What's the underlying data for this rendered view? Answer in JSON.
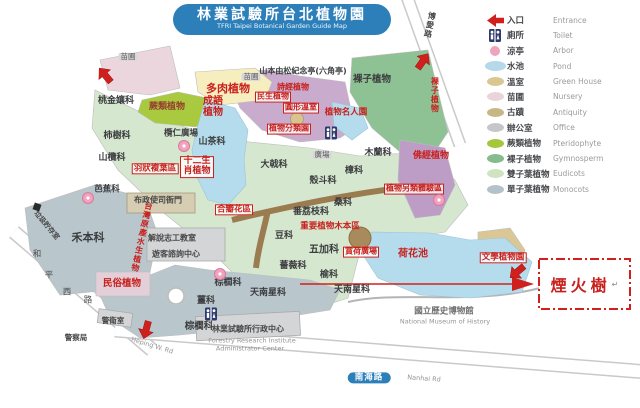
{
  "title": {
    "zh": "林業試驗所台北植物園",
    "en": "TFRI Taipei Botanical Garden Guide Map"
  },
  "legend": {
    "items": [
      {
        "id": "entrance",
        "zh": "入口",
        "en": "Entrance",
        "icon": "entrance-arrow-icon",
        "color": "#d0201e"
      },
      {
        "id": "toilet",
        "zh": "廁所",
        "en": "Toilet",
        "icon": "toilet-icon",
        "color": "#2d3a6e"
      },
      {
        "id": "arbor",
        "zh": "涼亭",
        "en": "Arbor",
        "icon": "circle",
        "color": "#f0a3bd"
      },
      {
        "id": "pond",
        "zh": "水池",
        "en": "Pond",
        "icon": "ellipse-wide",
        "color": "#b5d8ea"
      },
      {
        "id": "greenhouse",
        "zh": "溫室",
        "en": "Green House",
        "icon": "ellipse",
        "color": "#d9c78f"
      },
      {
        "id": "nursery",
        "zh": "苗圃",
        "en": "Nursery",
        "icon": "ellipse",
        "color": "#e9d4db"
      },
      {
        "id": "antiquity",
        "zh": "古蹟",
        "en": "Antiquity",
        "icon": "ellipse",
        "color": "#c8b687"
      },
      {
        "id": "office",
        "zh": "辦公室",
        "en": "Office",
        "icon": "ellipse",
        "color": "#c6c6ca"
      },
      {
        "id": "pteridophyte",
        "zh": "蕨類植物",
        "en": "Pteridophyte",
        "icon": "ellipse",
        "color": "#a5c73b"
      },
      {
        "id": "gymnosperm",
        "zh": "裸子植物",
        "en": "Gymnosperm",
        "icon": "ellipse",
        "color": "#85bb8d"
      },
      {
        "id": "eudicots",
        "zh": "雙子葉植物",
        "en": "Eudicots",
        "icon": "ellipse",
        "color": "#cfe3c2"
      },
      {
        "id": "monocots",
        "zh": "單子葉植物",
        "en": "Monocots",
        "icon": "ellipse",
        "color": "#b3c1c9"
      }
    ]
  },
  "callout": {
    "label": "煙火樹",
    "cursor_mark": "↵"
  },
  "map": {
    "labels": [
      {
        "id": "succulent-plants",
        "text": "多肉植物",
        "x": 228,
        "y": 89,
        "s": "red",
        "fs": 11
      },
      {
        "id": "idiom-plants",
        "text": "成語植物",
        "x": 213,
        "y": 107,
        "s": "red",
        "fs": 10,
        "w": 24
      },
      {
        "id": "fern-plants",
        "text": "蕨類植物",
        "x": 167,
        "y": 108,
        "s": "maroon",
        "fs": 9
      },
      {
        "id": "yamamoto-pavilion",
        "text": "山本由松紀念亭(六角亭)",
        "x": 303,
        "y": 72,
        "s": "dark",
        "fs": 8
      },
      {
        "id": "shijing-plants",
        "text": "詩經植物",
        "x": 293,
        "y": 88,
        "s": "red",
        "fs": 8
      },
      {
        "id": "minsheng-plants",
        "text": "民生植物",
        "x": 273,
        "y": 97,
        "s": "redbox",
        "fs": 8
      },
      {
        "id": "round-greenhouse",
        "text": "圓形溫室",
        "x": 301,
        "y": 108,
        "s": "redbox",
        "fs": 8
      },
      {
        "id": "plant-celebrity-garden",
        "text": "植物名人園",
        "x": 346,
        "y": 113,
        "s": "red",
        "fs": 8.5
      },
      {
        "id": "plant-taxonomy-garden",
        "text": "植物分類園",
        "x": 289,
        "y": 129,
        "s": "redbox",
        "fs": 8
      },
      {
        "id": "gymnosperm-area",
        "text": "裸子植物",
        "x": 372,
        "y": 80,
        "s": "dark",
        "fs": 9.5
      },
      {
        "id": "gymnosperm-area-vertical",
        "text": "裸子植物",
        "x": 434,
        "y": 95,
        "s": "redv",
        "fs": 8,
        "vert": true
      },
      {
        "id": "myrtaceae",
        "text": "桃金孃科",
        "x": 116,
        "y": 102,
        "s": "dark",
        "fs": 9
      },
      {
        "id": "nursery-label-1",
        "text": "苗圃",
        "x": 128,
        "y": 57,
        "s": "chip",
        "fs": 7.5
      },
      {
        "id": "nursery-label-2",
        "text": "苗圃",
        "x": 251,
        "y": 77,
        "s": "chip",
        "fs": 7.5
      },
      {
        "id": "ebenaceae",
        "text": "柿樹科",
        "x": 117,
        "y": 137,
        "s": "dark",
        "fs": 9
      },
      {
        "id": "sapotaceae",
        "text": "山欖科",
        "x": 112,
        "y": 159,
        "s": "dark",
        "fs": 9
      },
      {
        "id": "terminalia-plaza",
        "text": "欖仁廣場",
        "x": 181,
        "y": 134,
        "s": "dark",
        "fs": 8.5
      },
      {
        "id": "theaceae",
        "text": "山茶科",
        "x": 212,
        "y": 143,
        "s": "dark",
        "fs": 9
      },
      {
        "id": "pinnate-leaf-area",
        "text": "羽狀複葉區",
        "x": 155,
        "y": 169,
        "s": "redbox",
        "fs": 8.5
      },
      {
        "id": "zodiac-plants",
        "text": "十二生肖植物",
        "x": 197,
        "y": 167,
        "s": "redbox",
        "fs": 9,
        "w": 30
      },
      {
        "id": "euphorbiaceae",
        "text": "大戟科",
        "x": 274,
        "y": 166,
        "s": "dark",
        "fs": 9
      },
      {
        "id": "plaza-label",
        "text": "廣場",
        "x": 322,
        "y": 155,
        "s": "chip",
        "fs": 7.5
      },
      {
        "id": "magnoliaceae",
        "text": "木蘭科",
        "x": 378,
        "y": 154,
        "s": "dark",
        "fs": 9
      },
      {
        "id": "lauraceae",
        "text": "樟科",
        "x": 354,
        "y": 172,
        "s": "dark",
        "fs": 9
      },
      {
        "id": "fagaceae",
        "text": "殼斗科",
        "x": 323,
        "y": 182,
        "s": "dark",
        "fs": 9
      },
      {
        "id": "moraceae",
        "text": "桑科",
        "x": 343,
        "y": 204,
        "s": "dark",
        "fs": 9
      },
      {
        "id": "annonaceae",
        "text": "番荔枝科",
        "x": 311,
        "y": 213,
        "s": "dark",
        "fs": 9
      },
      {
        "id": "buddhist-sutra-plants",
        "text": "佛經植物",
        "x": 431,
        "y": 157,
        "s": "red",
        "fs": 9
      },
      {
        "id": "plant-alt-experience-area",
        "text": "植物另類體驗區",
        "x": 414,
        "y": 189,
        "s": "redbox",
        "fs": 8
      },
      {
        "id": "sympetalae-area",
        "text": "合瓣花區",
        "x": 234,
        "y": 210,
        "s": "redbox",
        "fs": 8.5
      },
      {
        "id": "fabaceae",
        "text": "豆科",
        "x": 284,
        "y": 237,
        "s": "dark",
        "fs": 9
      },
      {
        "id": "important-woody-plants-area",
        "text": "重要植物木本區",
        "x": 330,
        "y": 227,
        "s": "red",
        "fs": 8.5
      },
      {
        "id": "araliaceae",
        "text": "五加科",
        "x": 324,
        "y": 250,
        "s": "dark",
        "fs": 10
      },
      {
        "id": "rosaceae",
        "text": "薔薇科",
        "x": 293,
        "y": 267,
        "s": "dark",
        "fs": 9
      },
      {
        "id": "ulmaceae",
        "text": "榆科",
        "x": 329,
        "y": 276,
        "s": "dark",
        "fs": 9
      },
      {
        "id": "lotus-viewing-plaza",
        "text": "賞荷廣場",
        "x": 361,
        "y": 252,
        "s": "redbox",
        "fs": 8
      },
      {
        "id": "lotus-pond",
        "text": "荷花池",
        "x": 413,
        "y": 254,
        "s": "red",
        "fs": 10
      },
      {
        "id": "taiwan-native-aquatic-plants",
        "text": "台灣原產水生植物",
        "x": 141,
        "y": 237,
        "s": "redv",
        "fs": 8,
        "vert": true,
        "rot": 12
      },
      {
        "id": "poaceae",
        "text": "禾本科",
        "x": 88,
        "y": 238,
        "s": "dark",
        "fs": 11
      },
      {
        "id": "musaceae",
        "text": "芭蕉科",
        "x": 107,
        "y": 190,
        "s": "dark",
        "fs": 8.5
      },
      {
        "id": "volunteer-classroom",
        "text": "解說志工教室",
        "x": 172,
        "y": 239,
        "s": "bldg",
        "fs": 8
      },
      {
        "id": "visitor-information-center",
        "text": "遊客諮詢中心",
        "x": 176,
        "y": 255,
        "s": "bldg",
        "fs": 8
      },
      {
        "id": "provincial-admin-hall",
        "text": "布政使司衙門",
        "x": 158,
        "y": 201,
        "s": "bldg",
        "fs": 8
      },
      {
        "id": "folk-plants",
        "text": "民俗植物",
        "x": 122,
        "y": 284,
        "s": "red",
        "fs": 9.5
      },
      {
        "id": "arecaceae-1",
        "text": "棕櫚科",
        "x": 228,
        "y": 284,
        "s": "dark",
        "fs": 9
      },
      {
        "id": "zingiberaceae",
        "text": "薑科",
        "x": 206,
        "y": 302,
        "s": "dark",
        "fs": 9
      },
      {
        "id": "araceae-1",
        "text": "天南星科",
        "x": 268,
        "y": 294,
        "s": "dark",
        "fs": 9
      },
      {
        "id": "araceae-2",
        "text": "天南星科",
        "x": 352,
        "y": 291,
        "s": "dark",
        "fs": 9
      },
      {
        "id": "arecaceae-2",
        "text": "棕櫚科",
        "x": 199,
        "y": 327,
        "s": "dark",
        "fs": 9.5
      },
      {
        "id": "guard-room",
        "text": "警衛室",
        "x": 113,
        "y": 321,
        "s": "bldg",
        "fs": 7.5
      },
      {
        "id": "police-station",
        "text": "警察局",
        "x": 76,
        "y": 338,
        "s": "bldg",
        "fs": 7.5
      },
      {
        "id": "admin-center-zh",
        "text": "林業試驗所行政中心",
        "x": 248,
        "y": 330,
        "s": "bldg",
        "fs": 8
      },
      {
        "id": "admin-center-en-1",
        "text": "Forestry Research Institute",
        "x": 252,
        "y": 341,
        "s": "en",
        "fs": 6.5
      },
      {
        "id": "admin-center-en-2",
        "text": "Administrator Center",
        "x": 250,
        "y": 349,
        "s": "en",
        "fs": 6.5
      },
      {
        "id": "museum-zh",
        "text": "國立歷史博物館",
        "x": 444,
        "y": 312,
        "s": "gray",
        "fs": 8.5
      },
      {
        "id": "museum-en",
        "text": "National Museum of History",
        "x": 445,
        "y": 322,
        "s": "en",
        "fs": 6.5
      },
      {
        "id": "literary-plants-garden",
        "text": "文學植物園",
        "x": 503,
        "y": 258,
        "s": "redbox",
        "fs": 8.5
      },
      {
        "id": "heping-rd-en",
        "text": "Heping W. Rd",
        "x": 152,
        "y": 346,
        "s": "en",
        "fs": 6.5,
        "rot": 17
      },
      {
        "id": "nanhai-rd-pill",
        "text": "南海路",
        "x": 369,
        "y": 378,
        "s": "pill",
        "fs": 8.5
      },
      {
        "id": "nanhai-rd-en",
        "text": "Nanhai Rd",
        "x": 424,
        "y": 379,
        "s": "en",
        "fs": 6.5,
        "rot": 4
      },
      {
        "id": "boai-rd",
        "text": "博愛路",
        "x": 429,
        "y": 25,
        "s": "darkv",
        "fs": 8,
        "vert": true,
        "rot": 12
      },
      {
        "id": "trash-storage-room",
        "text": "垃圾貯存室",
        "x": 46,
        "y": 226,
        "s": "darkv",
        "fs": 7,
        "rot": 50
      },
      {
        "id": "heping-rd-char-1",
        "text": "和",
        "x": 37,
        "y": 255,
        "s": "road",
        "fs": 8.5
      },
      {
        "id": "heping-rd-char-2",
        "text": "平",
        "x": 49,
        "y": 276,
        "s": "road",
        "fs": 8.5
      },
      {
        "id": "heping-rd-char-3",
        "text": "西",
        "x": 67,
        "y": 293,
        "s": "road",
        "fs": 8.5
      },
      {
        "id": "heping-rd-char-4",
        "text": "路",
        "x": 88,
        "y": 301,
        "s": "road",
        "fs": 8.5
      }
    ],
    "markers": {
      "entrances": [
        {
          "x": 105,
          "y": 75,
          "rot": -40
        },
        {
          "x": 423,
          "y": 61,
          "rot": 35
        },
        {
          "x": 146,
          "y": 330,
          "rot": 195
        },
        {
          "x": 517,
          "y": 272,
          "rot": 230
        }
      ],
      "toilets": [
        {
          "x": 331,
          "y": 133
        },
        {
          "x": 211,
          "y": 314
        }
      ],
      "arbors": [
        {
          "x": 88,
          "y": 198
        },
        {
          "x": 184,
          "y": 146
        },
        {
          "x": 220,
          "y": 274
        },
        {
          "x": 439,
          "y": 200
        }
      ],
      "trash_points": [
        {
          "x": 37,
          "y": 207
        }
      ]
    }
  }
}
